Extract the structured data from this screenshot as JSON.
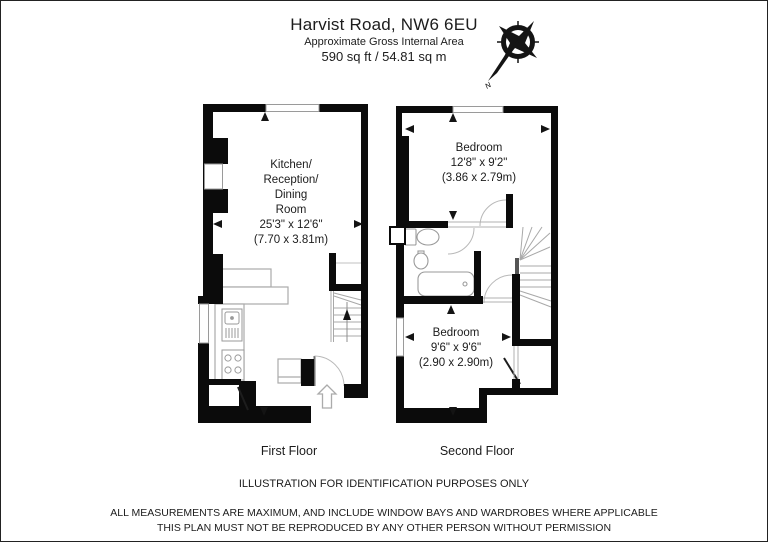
{
  "header": {
    "title": "Harvist Road, NW6 6EU",
    "subtitle": "Approximate Gross Internal Area",
    "area": "590 sq ft / 54.81 sq m"
  },
  "compass": {
    "label": "N"
  },
  "floors": {
    "first": {
      "label": "First Floor",
      "room": {
        "line1": "Kitchen/",
        "line2": "Reception/",
        "line3": "Dining",
        "line4": "Room",
        "dim_ft": "25'3\" x 12'6\"",
        "dim_m": "(7.70 x 3.81m)"
      }
    },
    "second": {
      "label": "Second Floor",
      "bedroom1": {
        "name": "Bedroom",
        "dim_ft": "12'8\" x 9'2\"",
        "dim_m": "(3.86 x 2.79m)"
      },
      "bedroom2": {
        "name": "Bedroom",
        "dim_ft": "9'6\" x 9'6\"",
        "dim_m": "(2.90 x 2.90m)"
      }
    }
  },
  "footer": {
    "note": "ILLUSTRATION FOR IDENTIFICATION PURPOSES ONLY",
    "disclaimer1": "ALL MEASUREMENTS ARE MAXIMUM, AND INCLUDE WINDOW BAYS AND WARDROBES WHERE APPLICABLE",
    "disclaimer2": "THIS PLAN MUST NOT BE REPRODUCED BY ANY OTHER PERSON WITHOUT PERMISSION"
  }
}
